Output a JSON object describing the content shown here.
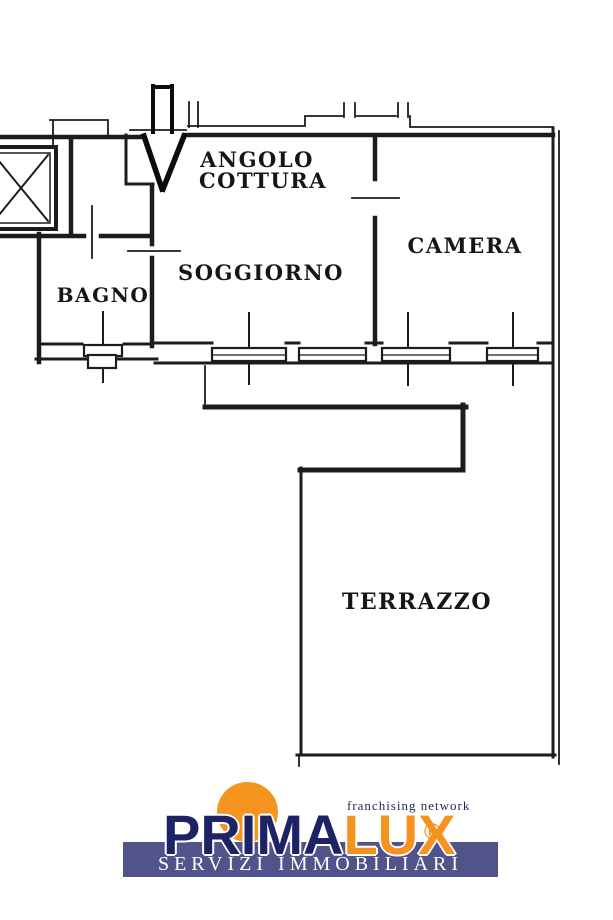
{
  "plan": {
    "labels": {
      "angolo_line1": "ANGOLO",
      "angolo_line2": "COTTURA",
      "soggiorno": "SOGGIORNO",
      "camera": "CAMERA",
      "bagno": "BAGNO",
      "terrazzo": "TERRAZZO"
    },
    "icons": {
      "entrance_arrow": "down-arrow-entrance-marker",
      "elevator": "elevator-shaft-x-box"
    },
    "colors": {
      "line": "#1c1c1c",
      "background": "#ffffff"
    }
  },
  "logo": {
    "brand_prima": "PRIMA",
    "brand_lux": "LUX",
    "registered_mark": "®",
    "tagline": "franchising network",
    "subtitle": "SERVIZI IMMOBILIARI",
    "colors": {
      "navy": "#1e2365",
      "orange": "#f5941f",
      "band": "#51548b",
      "subtitle_text": "#ffffff"
    }
  }
}
